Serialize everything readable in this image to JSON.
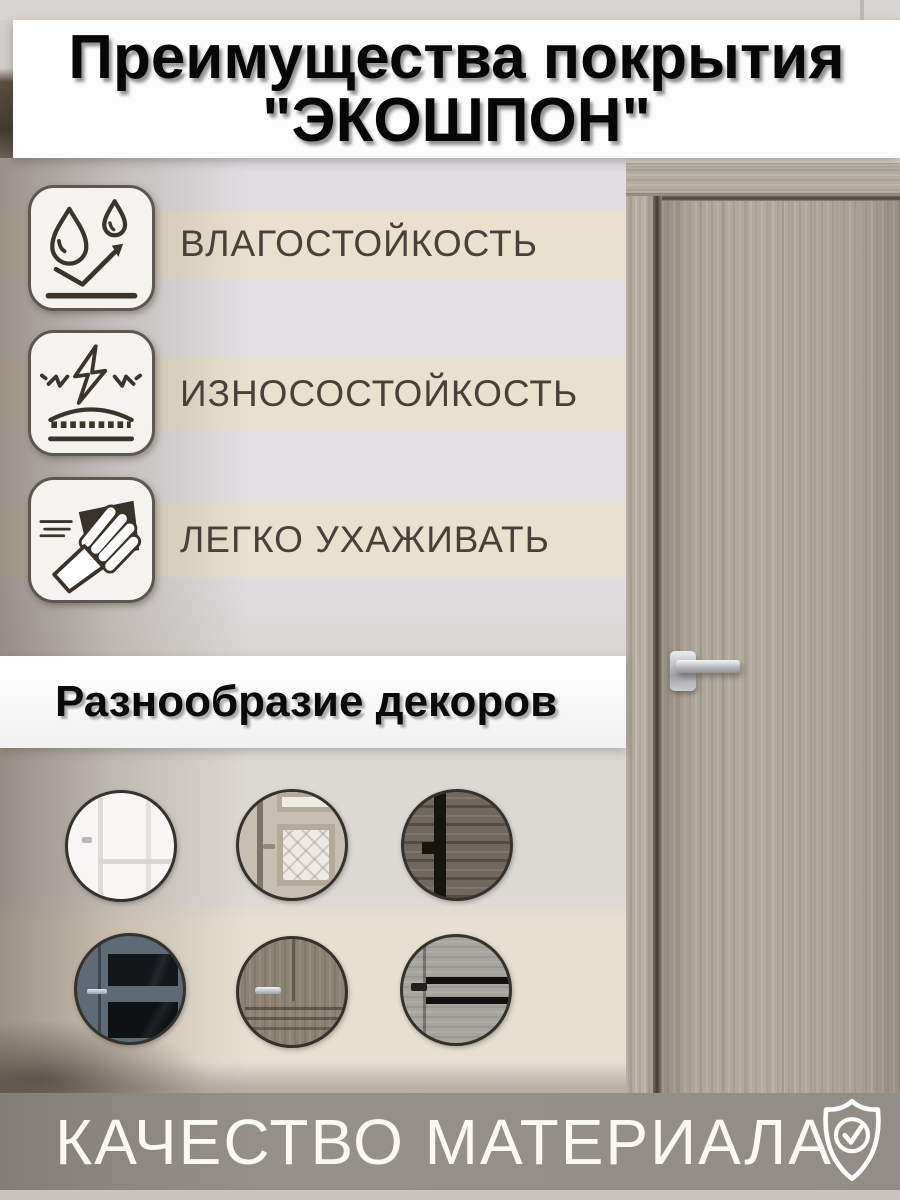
{
  "title": {
    "line1": "Преимущества покрытия",
    "line2": "\"ЭКОШПОН\""
  },
  "features": [
    {
      "label": "ВЛАГОСТОЙКОСТЬ",
      "icon": "water-drops-icon"
    },
    {
      "label": "ИЗНОСОСТОЙКОСТЬ",
      "icon": "impact-resistance-icon"
    },
    {
      "label": "ЛЕГКО УХАЖИВАТЬ",
      "icon": "wiping-hand-icon"
    }
  ],
  "decor": {
    "heading": "Разнообразие декоров",
    "items": [
      {
        "name": "white-classic-door"
      },
      {
        "name": "light-door-with-glass-insert"
      },
      {
        "name": "dark-rustic-wood-door"
      },
      {
        "name": "blue-gray-door-with-dark-glass"
      },
      {
        "name": "gray-wood-classic-door"
      },
      {
        "name": "light-gray-door-with-black-stripes"
      }
    ]
  },
  "footer": {
    "label": "КАЧЕСТВО МАТЕРИАЛА",
    "icon": "shield-check-icon"
  },
  "colors": {
    "cream_band": "#e9e1ce",
    "wall_gray": "#e2e0e3",
    "wall_taupe": "#9a9088",
    "door_wood": "#b0a79b",
    "footer_band": "#948e88",
    "text_dark": "#47413a",
    "panel_white": "#fbfbfb"
  }
}
